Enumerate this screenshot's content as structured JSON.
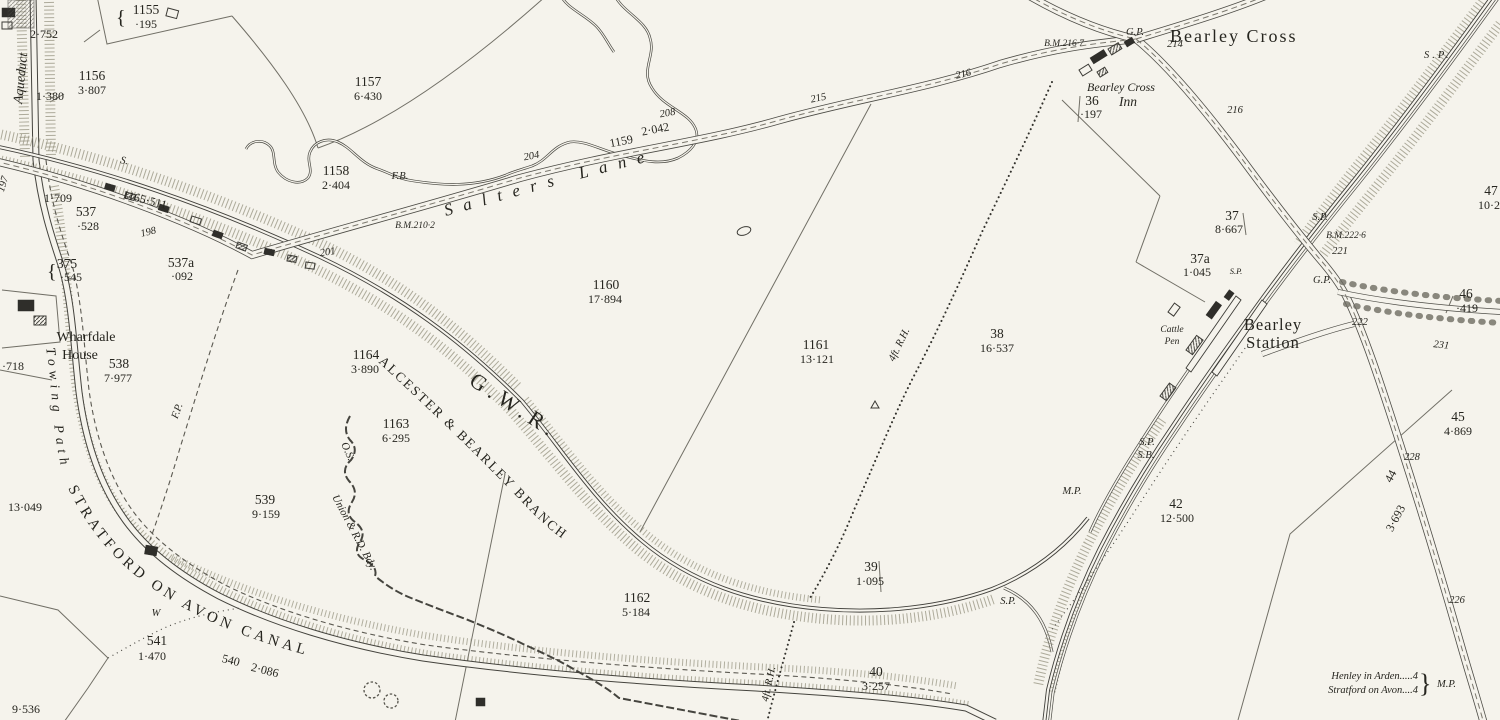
{
  "map": {
    "places": {
      "bearley_cross": "Bearley Cross",
      "bearley_station_1": "Bearley",
      "bearley_station_2": "Station",
      "inn_1": "Bearley Cross",
      "inn_2": "Inn",
      "wharfdale_1": "Wharfdale",
      "wharfdale_2": "House",
      "aqueduct": "Aqueduct",
      "salters_lane": "Salters Lane",
      "canal": "STRATFORD ON AVON CANAL",
      "towing_path": "Towing Path",
      "cattle_pen_1": "Cattle",
      "cattle_pen_2": "Pen"
    },
    "railway": {
      "company": "G.W.R.",
      "branch": "ALCESTER & BEARLEY BRANCH"
    },
    "boundary": {
      "union": "Union & R.D. Bdy.",
      "os": "O.S."
    },
    "fence_label": "4ft. R.H.",
    "milepost": {
      "line1": "Henley in Arden.....4",
      "line2": "Stratford on Avon....4",
      "label": "M.P."
    },
    "glyphs": {
      "brace_small": "{",
      "brace_big": "}"
    },
    "benchmarks": {
      "bm210": "B.M.210·2",
      "bm216": "B.M.216·7",
      "bm222": "B.M.222·6"
    },
    "parcels": {
      "p1155": {
        "no": "1155",
        "area": "·195"
      },
      "p1156": {
        "no": "1156",
        "area": "3·807"
      },
      "p1157": {
        "no": "1157",
        "area": "6·430"
      },
      "p1158": {
        "no": "1158",
        "area": "2·404"
      },
      "p1160": {
        "no": "1160",
        "area": "17·894"
      },
      "p1161": {
        "no": "1161",
        "area": "13·121"
      },
      "p1162": {
        "no": "1162",
        "area": "5·184"
      },
      "p1163": {
        "no": "1163",
        "area": "6·295"
      },
      "p1164": {
        "no": "1164",
        "area": "3·890"
      },
      "p36": {
        "no": "36",
        "area": "·197"
      },
      "p37": {
        "no": "37",
        "area": "8·667"
      },
      "p37a": {
        "no": "37a",
        "area": "1·045"
      },
      "p38": {
        "no": "38",
        "area": "16·537"
      },
      "p39": {
        "no": "39",
        "area": "1·095"
      },
      "p40": {
        "no": "40",
        "area": "3·257"
      },
      "p42": {
        "no": "42",
        "area": "12·500"
      },
      "p45": {
        "no": "45",
        "area": "4·869"
      },
      "p46": {
        "no": "46",
        "area": "·419"
      },
      "p47": {
        "no": "47",
        "area": "10·21"
      },
      "p375": {
        "no": "375",
        "area": "·545"
      },
      "p537": {
        "no": "537",
        "area": "·528"
      },
      "p537a": {
        "no": "537a",
        "area": "·092"
      },
      "p538": {
        "no": "538",
        "area": "7·977"
      },
      "p539": {
        "no": "539",
        "area": "9·159"
      },
      "p541": {
        "no": "541",
        "area": "1·470"
      }
    },
    "inline_parcels": {
      "p1165": "1165·511",
      "p1159_no": "1159",
      "p1159_area": "2·042",
      "p540_no": "540",
      "p540_area": "2·086",
      "p44_no": "44",
      "p44_area": "3·693"
    },
    "areas": {
      "a2752": "2·752",
      "a1380": "1·380",
      "a1709": "1·709",
      "a13049": "13·049",
      "a9536": "9·536",
      "a718": "·718"
    },
    "road_numbers": {
      "n197": "197",
      "n198": "198",
      "n201": "201",
      "n204": "204",
      "n208": "208",
      "n214": "214",
      "n215": "215",
      "n216a": "216",
      "n216b": "216",
      "n221": "221",
      "n222": "222",
      "n226": "226",
      "n228": "228",
      "n231": "231"
    },
    "abbr": {
      "fb": "F.B.",
      "fp": "F.P.",
      "gp": "G.P.",
      "sp": "S.P.",
      "sb": "S.B.",
      "mp": "M.P.",
      "w": "W",
      "s": "S."
    }
  }
}
